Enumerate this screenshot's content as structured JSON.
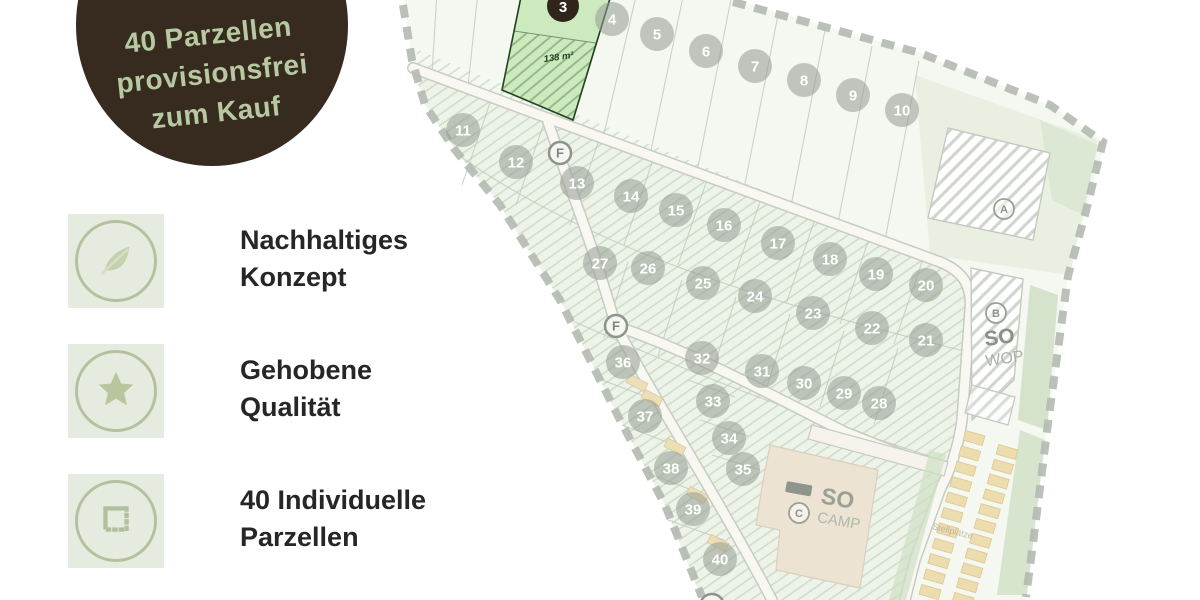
{
  "badge": {
    "line1": "40 Parzellen",
    "line2": "provisionsfrei",
    "line3": "zum Kauf"
  },
  "features": [
    {
      "icon": "leaf-icon",
      "label_line1": "Nachhaltiges",
      "label_line2": "Konzept"
    },
    {
      "icon": "star-icon",
      "label_line1": "Gehobene",
      "label_line2": "Qualität"
    },
    {
      "icon": "parcel-outline-icon",
      "label_line1": "40 Individuelle",
      "label_line2": "Parzellen"
    }
  ],
  "map": {
    "highlighted_parcel": {
      "number": "3",
      "area": "138 m²",
      "x": 563,
      "y": 6
    },
    "parcels": [
      {
        "n": "4",
        "x": 612,
        "y": 19
      },
      {
        "n": "5",
        "x": 657,
        "y": 34
      },
      {
        "n": "6",
        "x": 706,
        "y": 51
      },
      {
        "n": "7",
        "x": 755,
        "y": 66
      },
      {
        "n": "8",
        "x": 804,
        "y": 80
      },
      {
        "n": "9",
        "x": 853,
        "y": 95
      },
      {
        "n": "10",
        "x": 902,
        "y": 110
      },
      {
        "n": "11",
        "x": 463,
        "y": 130
      },
      {
        "n": "12",
        "x": 516,
        "y": 162
      },
      {
        "n": "13",
        "x": 577,
        "y": 183
      },
      {
        "n": "14",
        "x": 631,
        "y": 196
      },
      {
        "n": "15",
        "x": 676,
        "y": 210
      },
      {
        "n": "16",
        "x": 724,
        "y": 225
      },
      {
        "n": "17",
        "x": 778,
        "y": 243
      },
      {
        "n": "18",
        "x": 830,
        "y": 259
      },
      {
        "n": "19",
        "x": 876,
        "y": 274
      },
      {
        "n": "20",
        "x": 926,
        "y": 285
      },
      {
        "n": "21",
        "x": 926,
        "y": 340
      },
      {
        "n": "22",
        "x": 872,
        "y": 328
      },
      {
        "n": "23",
        "x": 813,
        "y": 313
      },
      {
        "n": "24",
        "x": 755,
        "y": 296
      },
      {
        "n": "25",
        "x": 703,
        "y": 283
      },
      {
        "n": "26",
        "x": 648,
        "y": 268
      },
      {
        "n": "27",
        "x": 600,
        "y": 263
      },
      {
        "n": "28",
        "x": 879,
        "y": 403
      },
      {
        "n": "29",
        "x": 844,
        "y": 393
      },
      {
        "n": "30",
        "x": 804,
        "y": 383
      },
      {
        "n": "31",
        "x": 762,
        "y": 371
      },
      {
        "n": "32",
        "x": 702,
        "y": 358
      },
      {
        "n": "33",
        "x": 713,
        "y": 401
      },
      {
        "n": "34",
        "x": 729,
        "y": 438
      },
      {
        "n": "35",
        "x": 743,
        "y": 469
      },
      {
        "n": "36",
        "x": 623,
        "y": 362
      },
      {
        "n": "37",
        "x": 645,
        "y": 416
      },
      {
        "n": "38",
        "x": 671,
        "y": 468
      },
      {
        "n": "39",
        "x": 693,
        "y": 509
      },
      {
        "n": "40",
        "x": 720,
        "y": 559
      }
    ],
    "road_markers": [
      {
        "label": "F",
        "x": 560,
        "y": 153
      },
      {
        "label": "F",
        "x": 616,
        "y": 326
      }
    ],
    "zone_markers": [
      {
        "label": "A",
        "x": 1004,
        "y": 209
      },
      {
        "label": "B",
        "x": 996,
        "y": 313
      },
      {
        "label": "C",
        "x": 799,
        "y": 513
      }
    ],
    "zone_label_wop": {
      "line1": "SO",
      "line2": "WOP"
    },
    "zone_label_camp": {
      "line1": "SO",
      "line2": "CAMP"
    },
    "parking_label": "Stellplätze"
  },
  "colors": {
    "badge_bg": "#372b20",
    "badge_text": "#b7c9a1",
    "accent_green": "#b5c19e",
    "highlight_green": "#cdeabf",
    "text_dark": "#262626"
  }
}
